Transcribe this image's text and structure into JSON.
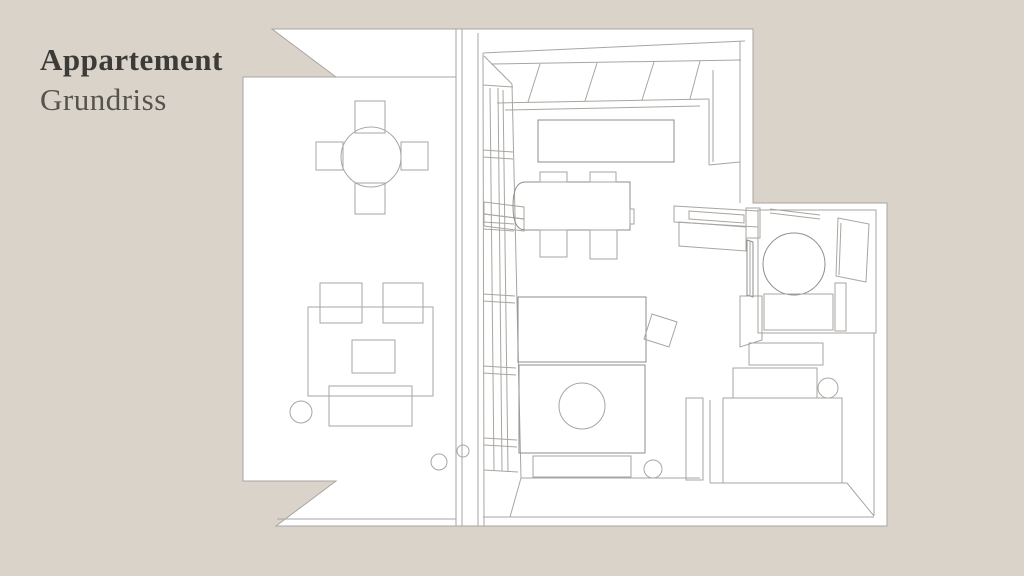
{
  "page": {
    "title_line1": "Appartement",
    "title_line2": "Grundriss"
  },
  "plan": {
    "rooms": [
      {
        "name": "terrace",
        "furniture": [
          "round-dining-table",
          "four-chairs",
          "rug",
          "two-armchairs",
          "coffee-table",
          "sofa",
          "plants"
        ]
      },
      {
        "name": "living-kitchen",
        "furniture": [
          "kitchen-counter",
          "kitchen-island",
          "dining-table",
          "chairs",
          "washbasin"
        ]
      },
      {
        "name": "bedroom",
        "furniture": [
          "bed",
          "bench",
          "nightstand",
          "stool"
        ]
      },
      {
        "name": "bathroom",
        "furniture": [
          "round-shower",
          "glass-panel",
          "bench",
          "towel-rail"
        ]
      },
      {
        "name": "wardrobe-corner",
        "furniture": [
          "closet-units",
          "side-table"
        ]
      }
    ]
  },
  "colors": {
    "background": "#d9d3ca",
    "plan_fill": "#ffffff",
    "line": "#a9a6a1",
    "line_dark": "#8f8d89",
    "title_primary": "#3c3b37",
    "title_secondary": "#55534d"
  }
}
